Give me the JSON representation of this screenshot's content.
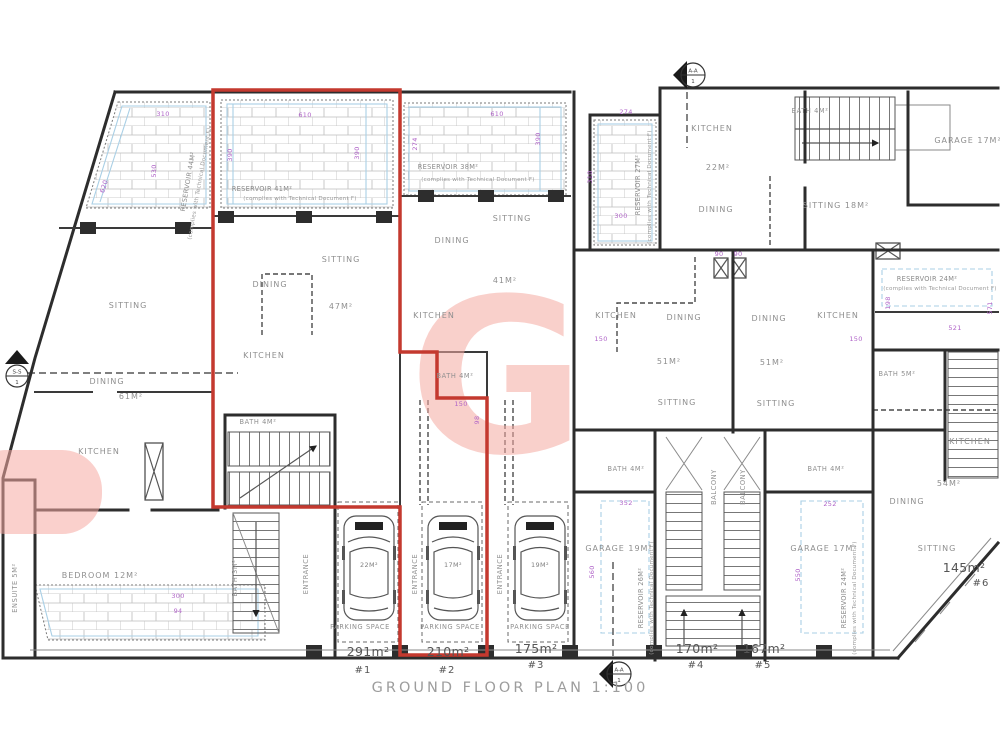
{
  "title": "GROUND FLOOR PLAN 1:100",
  "watermark": {
    "letter": "G",
    "color": "#f5aaa2"
  },
  "colors": {
    "unit_outline_red": "#c4392f",
    "dim_purple": "#b064c8",
    "hatch_blue": "#a9cfe5",
    "wall_black": "#2d2d2d",
    "label_gray": "#8f8f8f"
  },
  "markers": [
    {
      "label": "S-S",
      "number": "1"
    },
    {
      "label": "A-A",
      "number": "1"
    },
    {
      "label": "A-A",
      "number": "1"
    }
  ],
  "units": [
    {
      "area": "291m²",
      "number": "#1",
      "ax": 368,
      "ay": 656,
      "nx": 363,
      "ny": 673
    },
    {
      "area": "210m²",
      "number": "#2",
      "ax": 448,
      "ay": 656,
      "nx": 447,
      "ny": 673
    },
    {
      "area": "175m²",
      "number": "#3",
      "ax": 536,
      "ay": 653,
      "nx": 536,
      "ny": 668
    },
    {
      "area": "170m²",
      "number": "#4",
      "ax": 697,
      "ay": 653,
      "nx": 696,
      "ny": 668
    },
    {
      "area": "167m²",
      "number": "#5",
      "ax": 764,
      "ay": 653,
      "nx": 763,
      "ny": 668
    },
    {
      "area": "145m²",
      "number": "#6",
      "ax": 964,
      "ay": 572,
      "nx": 981,
      "ny": 586
    }
  ],
  "labels": [
    {
      "t": "GROUND FLOOR PLAN 1:100",
      "x": 510,
      "y": 692,
      "s": "title",
      "n": "plan-title"
    },
    {
      "t": "SITTING",
      "x": 128,
      "y": 308,
      "s": "room"
    },
    {
      "t": "DINING",
      "x": 107,
      "y": 384,
      "s": "room"
    },
    {
      "t": "61M²",
      "x": 131,
      "y": 399,
      "s": "room"
    },
    {
      "t": "KITCHEN",
      "x": 99,
      "y": 454,
      "s": "room"
    },
    {
      "t": "BEDROOM 12M²",
      "x": 100,
      "y": 578,
      "s": "room"
    },
    {
      "t": "ENSUITE 5M²",
      "x": 17,
      "y": 588,
      "r": -90,
      "s": "small"
    },
    {
      "t": "BATH 4M²",
      "x": 258,
      "y": 424,
      "s": "small"
    },
    {
      "t": "BATH 3M²",
      "x": 237,
      "y": 578,
      "r": -90,
      "s": "small"
    },
    {
      "t": "SITTING",
      "x": 341,
      "y": 262,
      "s": "room"
    },
    {
      "t": "DINING",
      "x": 270,
      "y": 287,
      "s": "room"
    },
    {
      "t": "47M²",
      "x": 341,
      "y": 309,
      "s": "room"
    },
    {
      "t": "KITCHEN",
      "x": 264,
      "y": 358,
      "s": "room"
    },
    {
      "t": "BATH 4M²",
      "x": 455,
      "y": 378,
      "s": "small"
    },
    {
      "t": "SITTING",
      "x": 512,
      "y": 221,
      "s": "room"
    },
    {
      "t": "DINING",
      "x": 452,
      "y": 243,
      "s": "room"
    },
    {
      "t": "41M²",
      "x": 505,
      "y": 283,
      "s": "room"
    },
    {
      "t": "KITCHEN",
      "x": 434,
      "y": 318,
      "s": "room"
    },
    {
      "t": "KITCHEN",
      "x": 712,
      "y": 131,
      "s": "room"
    },
    {
      "t": "22M²",
      "x": 718,
      "y": 170,
      "s": "room"
    },
    {
      "t": "DINING",
      "x": 716,
      "y": 212,
      "s": "room"
    },
    {
      "t": "BATH 4M²",
      "x": 810,
      "y": 113,
      "s": "small"
    },
    {
      "t": "GARAGE 17M²",
      "x": 968,
      "y": 143,
      "s": "room"
    },
    {
      "t": "SITTING 18M²",
      "x": 836,
      "y": 208,
      "s": "room"
    },
    {
      "t": "KITCHEN",
      "x": 616,
      "y": 318,
      "s": "room"
    },
    {
      "t": "DINING",
      "x": 684,
      "y": 320,
      "s": "room"
    },
    {
      "t": "51M²",
      "x": 669,
      "y": 364,
      "s": "room"
    },
    {
      "t": "SITTING",
      "x": 677,
      "y": 405,
      "s": "room"
    },
    {
      "t": "DINING",
      "x": 769,
      "y": 321,
      "s": "room"
    },
    {
      "t": "KITCHEN",
      "x": 838,
      "y": 318,
      "s": "room"
    },
    {
      "t": "51M²",
      "x": 772,
      "y": 365,
      "s": "room"
    },
    {
      "t": "SITTING",
      "x": 776,
      "y": 406,
      "s": "room"
    },
    {
      "t": "BATH 5M²",
      "x": 897,
      "y": 376,
      "s": "small"
    },
    {
      "t": "KITCHEN",
      "x": 970,
      "y": 444,
      "s": "room"
    },
    {
      "t": "54M²",
      "x": 949,
      "y": 486,
      "s": "room"
    },
    {
      "t": "DINING",
      "x": 907,
      "y": 504,
      "s": "room"
    },
    {
      "t": "SITTING",
      "x": 937,
      "y": 551,
      "s": "room"
    },
    {
      "t": "BATH 4M²",
      "x": 626,
      "y": 471,
      "s": "small"
    },
    {
      "t": "BATH 4M²",
      "x": 826,
      "y": 471,
      "s": "small"
    },
    {
      "t": "GARAGE 19M²",
      "x": 619,
      "y": 551,
      "s": "room"
    },
    {
      "t": "GARAGE 17M²",
      "x": 824,
      "y": 551,
      "s": "room"
    },
    {
      "t": "BALCONY",
      "x": 716,
      "y": 487,
      "r": -90,
      "s": "small",
      "n": "balcony-label"
    },
    {
      "t": "BALCONY",
      "x": 745,
      "y": 487,
      "r": -90,
      "s": "small",
      "n": "balcony-label"
    },
    {
      "t": "PARKING SPACE",
      "x": 360,
      "y": 629,
      "s": "small",
      "n": "parking-space-label"
    },
    {
      "t": "PARKING SPACE",
      "x": 450,
      "y": 629,
      "s": "small",
      "n": "parking-space-label"
    },
    {
      "t": "PARKING SPACE",
      "x": 540,
      "y": 629,
      "s": "small",
      "n": "parking-space-label"
    },
    {
      "t": "ENTRANCE",
      "x": 308,
      "y": 574,
      "r": -90,
      "s": "small",
      "n": "entrance-label"
    },
    {
      "t": "ENTRANCE",
      "x": 417,
      "y": 574,
      "r": -90,
      "s": "small",
      "n": "entrance-label"
    },
    {
      "t": "ENTRANCE",
      "x": 502,
      "y": 574,
      "r": -90,
      "s": "small",
      "n": "entrance-label"
    },
    {
      "t": "22M²",
      "x": 369,
      "y": 567,
      "s": "car",
      "n": "car-area-label"
    },
    {
      "t": "17M²",
      "x": 453,
      "y": 567,
      "s": "car",
      "n": "car-area-label"
    },
    {
      "t": "19M²",
      "x": 540,
      "y": 567,
      "s": "car",
      "n": "car-area-label"
    },
    {
      "t": "RESERVOIR 44M²",
      "x": 190,
      "y": 182,
      "r": -80,
      "s": "res",
      "n": "reservoir-label"
    },
    {
      "t": "(complies with Technical Document F)",
      "x": 201,
      "y": 184,
      "r": -80,
      "s": "note",
      "n": "reservoir-note"
    },
    {
      "t": "RESERVOIR 41M²",
      "x": 262,
      "y": 191,
      "s": "res",
      "n": "reservoir-label"
    },
    {
      "t": "(complies with Technical Document F)",
      "x": 300,
      "y": 200,
      "s": "note",
      "n": "reservoir-note"
    },
    {
      "t": "RESERVOIR 38M²",
      "x": 448,
      "y": 169,
      "s": "res",
      "n": "reservoir-label"
    },
    {
      "t": "(complies with Technical Document F)",
      "x": 478,
      "y": 181,
      "s": "note",
      "n": "reservoir-note"
    },
    {
      "t": "RESERVOIR 27M²",
      "x": 640,
      "y": 185,
      "r": -90,
      "s": "res",
      "n": "reservoir-label"
    },
    {
      "t": "(complies with Technical Document F)",
      "x": 651,
      "y": 187,
      "r": -90,
      "s": "note",
      "n": "reservoir-note"
    },
    {
      "t": "RESERVOIR 24M²",
      "x": 927,
      "y": 281,
      "s": "res",
      "n": "reservoir-label"
    },
    {
      "t": "(complies with Technical Document F)",
      "x": 940,
      "y": 290,
      "s": "note",
      "n": "reservoir-note"
    },
    {
      "t": "RESERVOIR 26M²",
      "x": 643,
      "y": 598,
      "r": -90,
      "s": "res",
      "n": "reservoir-label"
    },
    {
      "t": "(complies with Technical Document F)",
      "x": 653,
      "y": 598,
      "r": -90,
      "s": "note",
      "n": "reservoir-note"
    },
    {
      "t": "RESERVOIR 24M²",
      "x": 846,
      "y": 598,
      "r": -90,
      "s": "res",
      "n": "reservoir-label"
    },
    {
      "t": "(complies with Technical Document F)",
      "x": 856,
      "y": 598,
      "r": -90,
      "s": "note",
      "n": "reservoir-note"
    },
    {
      "t": "310",
      "x": 163,
      "y": 116,
      "s": "dim"
    },
    {
      "t": "530",
      "x": 156,
      "y": 171,
      "r": -90,
      "s": "dim"
    },
    {
      "t": "620",
      "x": 106,
      "y": 187,
      "r": -73,
      "s": "dim"
    },
    {
      "t": "610",
      "x": 305,
      "y": 117,
      "s": "dim"
    },
    {
      "t": "390",
      "x": 232,
      "y": 155,
      "r": -90,
      "s": "dim"
    },
    {
      "t": "390",
      "x": 359,
      "y": 153,
      "r": -90,
      "s": "dim"
    },
    {
      "t": "610",
      "x": 497,
      "y": 116,
      "s": "dim"
    },
    {
      "t": "274",
      "x": 417,
      "y": 144,
      "r": -90,
      "s": "dim"
    },
    {
      "t": "390",
      "x": 540,
      "y": 139,
      "r": -90,
      "s": "dim"
    },
    {
      "t": "274",
      "x": 626,
      "y": 114,
      "s": "dim"
    },
    {
      "t": "310",
      "x": 592,
      "y": 177,
      "r": -90,
      "s": "dim"
    },
    {
      "t": "300",
      "x": 621,
      "y": 218,
      "s": "dim"
    },
    {
      "t": "198",
      "x": 890,
      "y": 303,
      "r": -90,
      "s": "dim"
    },
    {
      "t": "521",
      "x": 955,
      "y": 330,
      "s": "dim"
    },
    {
      "t": "571",
      "x": 992,
      "y": 308,
      "r": -90,
      "s": "dim"
    },
    {
      "t": "352",
      "x": 626,
      "y": 505,
      "s": "dim"
    },
    {
      "t": "560",
      "x": 594,
      "y": 572,
      "r": -90,
      "s": "dim"
    },
    {
      "t": "252",
      "x": 830,
      "y": 506,
      "s": "dim"
    },
    {
      "t": "550",
      "x": 800,
      "y": 575,
      "r": -90,
      "s": "dim"
    },
    {
      "t": "150",
      "x": 601,
      "y": 341,
      "s": "dim"
    },
    {
      "t": "150",
      "x": 856,
      "y": 341,
      "s": "dim"
    },
    {
      "t": "150",
      "x": 461,
      "y": 406,
      "s": "dim"
    },
    {
      "t": "98",
      "x": 479,
      "y": 420,
      "r": -90,
      "s": "dim"
    },
    {
      "t": "300",
      "x": 178,
      "y": 598,
      "s": "dim"
    },
    {
      "t": "94",
      "x": 178,
      "y": 613,
      "s": "dim"
    },
    {
      "t": "90",
      "x": 719,
      "y": 256,
      "s": "dim"
    },
    {
      "t": "90",
      "x": 738,
      "y": 256,
      "s": "dim"
    }
  ]
}
